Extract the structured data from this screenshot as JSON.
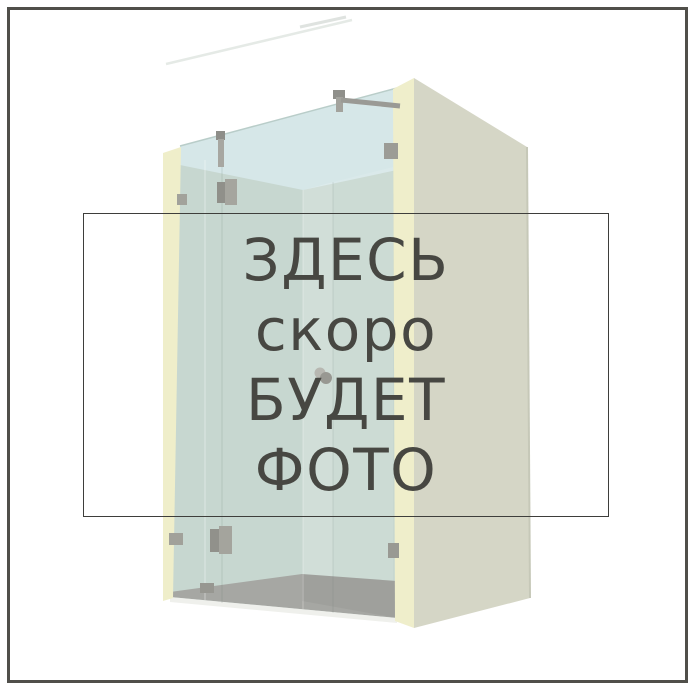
{
  "placeholder": {
    "lines": [
      "ЗДЕСЬ",
      "скоро",
      "БУДЕТ",
      "ФОТО"
    ]
  },
  "illustration": {
    "subject": "glass-shower-enclosure-3d-render"
  },
  "colors": {
    "background": "#ffffff",
    "frame_border": "#504f4a",
    "box_border": "#3e3e3b",
    "text": "#474742",
    "glass_green": "#c7d7d0",
    "glass_blue": "#d6e7e8",
    "wall_beige": "#d5d6c6",
    "wall_edge_cream": "#efeeca",
    "floor_gray": "#a6a7a3",
    "hardware_gray": "#9c9c96"
  }
}
